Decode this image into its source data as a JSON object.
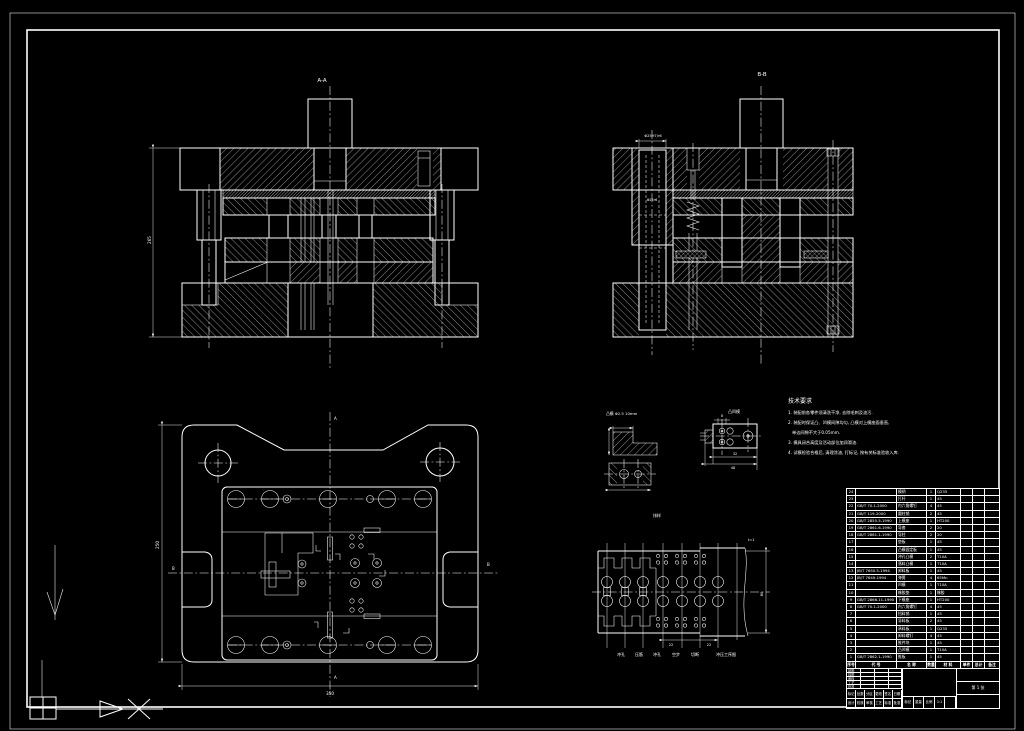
{
  "sheet": {
    "background": "#000000",
    "line_color": "#ffffff"
  },
  "sections": {
    "a_label": "A-A",
    "b_label": "B-B"
  },
  "dims": {
    "a_height": "265",
    "b_pillar": "Φ25H7/r6",
    "b_pillar2": "Φ25r6",
    "plan_width": "350",
    "plan_height": "250",
    "plan_mark_left": "B",
    "plan_mark_right": "B",
    "plan_mark_top": "A",
    "plan_mark_bottom": "A",
    "strip_step": "22",
    "strip_step2": "22",
    "strip_width": "80",
    "strip_t": "t=1",
    "detail1_label": "凸模 Φ2.5 10mm",
    "detail2_label": "凸凹模",
    "detail2_dim_top": "8",
    "detail2_dim1": "32",
    "detail2_dim2": "48"
  },
  "strip": {
    "title": "排样",
    "stations": [
      "冲孔",
      "压筋",
      "冲孔",
      "空步",
      "切断",
      "冲压工序图"
    ]
  },
  "notes": {
    "title": "技术要求",
    "lines": [
      "1. 装配前各零件须清洗干净, 去除毛刺及油污.",
      "2. 装配时保证凸、凹模间隙均匀, 凸模对上模座面垂直,",
      "    单边间隙不大于0.05mm.",
      "3. 模具闭合高度及活动部位加润滑油.",
      "4. 试模检验合格后, 清理涂油, 打标记, 按有关标准验收入库."
    ]
  },
  "bom": {
    "headers": {
      "seq": "序号",
      "code": "代 号",
      "name": "名 称",
      "qty": "数量",
      "material": "材 料",
      "unit": "单件",
      "total": "总计",
      "note": "备注"
    },
    "rows": [
      {
        "seq": "24",
        "code": "",
        "name": "模柄",
        "qty": "1",
        "mat": "Q235",
        "u": "",
        "t": "",
        "note": ""
      },
      {
        "seq": "23",
        "code": "",
        "name": "打杆",
        "qty": "1",
        "mat": "45",
        "u": "",
        "t": "",
        "note": ""
      },
      {
        "seq": "22",
        "code": "GB/T 70.1-2000",
        "name": "内六角螺钉",
        "qty": "4",
        "mat": "45",
        "u": "",
        "t": "",
        "note": ""
      },
      {
        "seq": "21",
        "code": "GB/T 119-2000",
        "name": "圆柱销",
        "qty": "2",
        "mat": "45",
        "u": "",
        "t": "",
        "note": ""
      },
      {
        "seq": "20",
        "code": "GB/T 2855.5-1990",
        "name": "上模座",
        "qty": "1",
        "mat": "HT200",
        "u": "",
        "t": "",
        "note": ""
      },
      {
        "seq": "19",
        "code": "GB/T 2861.6-1990",
        "name": "导套",
        "qty": "2",
        "mat": "20",
        "u": "",
        "t": "",
        "note": ""
      },
      {
        "seq": "18",
        "code": "GB/T 2861.1-1990",
        "name": "导柱",
        "qty": "2",
        "mat": "20",
        "u": "",
        "t": "",
        "note": ""
      },
      {
        "seq": "17",
        "code": "",
        "name": "垫板",
        "qty": "1",
        "mat": "45",
        "u": "",
        "t": "",
        "note": ""
      },
      {
        "seq": "16",
        "code": "",
        "name": "凸模固定板",
        "qty": "1",
        "mat": "45",
        "u": "",
        "t": "",
        "note": ""
      },
      {
        "seq": "15",
        "code": "",
        "name": "冲孔凸模",
        "qty": "2",
        "mat": "T10A",
        "u": "",
        "t": "",
        "note": ""
      },
      {
        "seq": "14",
        "code": "",
        "name": "落料凸模",
        "qty": "1",
        "mat": "T10A",
        "u": "",
        "t": "",
        "note": ""
      },
      {
        "seq": "13",
        "code": "JB/T 7650.5-1994",
        "name": "卸料板",
        "qty": "1",
        "mat": "45",
        "u": "",
        "t": "",
        "note": ""
      },
      {
        "seq": "12",
        "code": "JB/T 7649-1994",
        "name": "弹簧",
        "qty": "4",
        "mat": "65Mn",
        "u": "",
        "t": "",
        "note": ""
      },
      {
        "seq": "11",
        "code": "",
        "name": "凹模",
        "qty": "1",
        "mat": "T10A",
        "u": "",
        "t": "",
        "note": ""
      },
      {
        "seq": "10",
        "code": "",
        "name": "橡胶垫",
        "qty": "1",
        "mat": "橡胶",
        "u": "",
        "t": "",
        "note": ""
      },
      {
        "seq": "9",
        "code": "GB/T 2866.11-1990",
        "name": "下模座",
        "qty": "1",
        "mat": "HT200",
        "u": "",
        "t": "",
        "note": ""
      },
      {
        "seq": "8",
        "code": "GB/T 70.1-2000",
        "name": "内六角螺钉",
        "qty": "4",
        "mat": "45",
        "u": "",
        "t": "",
        "note": ""
      },
      {
        "seq": "7",
        "code": "",
        "name": "挡料销",
        "qty": "1",
        "mat": "45",
        "u": "",
        "t": "",
        "note": ""
      },
      {
        "seq": "6",
        "code": "",
        "name": "导料板",
        "qty": "2",
        "mat": "45",
        "u": "",
        "t": "",
        "note": ""
      },
      {
        "seq": "5",
        "code": "",
        "name": "承料板",
        "qty": "1",
        "mat": "Q235",
        "u": "",
        "t": "",
        "note": ""
      },
      {
        "seq": "4",
        "code": "",
        "name": "卸料螺钉",
        "qty": "4",
        "mat": "45",
        "u": "",
        "t": "",
        "note": ""
      },
      {
        "seq": "3",
        "code": "",
        "name": "推件块",
        "qty": "1",
        "mat": "45",
        "u": "",
        "t": "",
        "note": ""
      },
      {
        "seq": "2",
        "code": "",
        "name": "凸凹模",
        "qty": "1",
        "mat": "T10A",
        "u": "",
        "t": "",
        "note": ""
      },
      {
        "seq": "1",
        "code": "GB/T 2862.1-1990",
        "name": "推板",
        "qty": "1",
        "mat": "45",
        "u": "",
        "t": "",
        "note": ""
      }
    ]
  },
  "titleblock": {
    "sign_rows": [
      "制图",
      "描图",
      "审核",
      "工艺",
      "批准"
    ],
    "change_row": [
      "标记",
      "处数",
      "分区",
      "更改",
      "签名",
      "日期"
    ],
    "row2": [
      "设计",
      "校核",
      "审核",
      "工艺",
      "标准",
      "批准"
    ],
    "center_cells": [
      "标记",
      "重量",
      "比例",
      "1:1",
      ""
    ],
    "right_boxes": [
      "",
      "第 1 张",
      ""
    ]
  }
}
